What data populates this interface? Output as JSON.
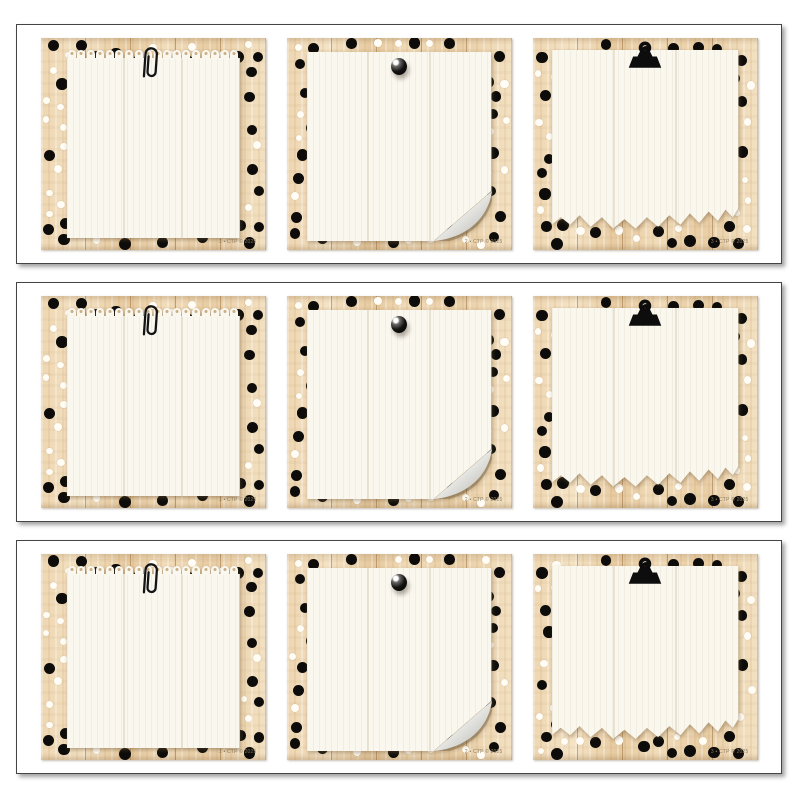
{
  "sheet": {
    "strip_count": 3,
    "cards_per_strip": 3
  },
  "strips": [
    {
      "cards": [
        {
          "number": "1",
          "attachment": "paper-clip",
          "paper_style": "perforated-notepad",
          "code": "1 • CTP © 2025"
        },
        {
          "number": "2",
          "attachment": "push-pin",
          "paper_style": "curled-corner",
          "code": "2 • CTP © 2025"
        },
        {
          "number": "3",
          "attachment": "binder-clip",
          "paper_style": "torn-bottom",
          "code": "3 • CTP © 2025"
        }
      ]
    },
    {
      "cards": [
        {
          "number": "1",
          "attachment": "paper-clip",
          "paper_style": "perforated-notepad",
          "code": "1 • CTP © 2025"
        },
        {
          "number": "2",
          "attachment": "push-pin",
          "paper_style": "curled-corner",
          "code": "2 • CTP © 2025"
        },
        {
          "number": "3",
          "attachment": "binder-clip",
          "paper_style": "torn-bottom",
          "code": "3 • CTP © 2025"
        }
      ]
    },
    {
      "cards": [
        {
          "number": "1",
          "attachment": "paper-clip",
          "paper_style": "perforated-notepad",
          "code": "1 • CTP © 2025"
        },
        {
          "number": "2",
          "attachment": "push-pin",
          "paper_style": "curled-corner",
          "code": "2 • CTP © 2025"
        },
        {
          "number": "3",
          "attachment": "binder-clip",
          "paper_style": "torn-bottom",
          "code": "3 • CTP © 2025"
        }
      ]
    }
  ],
  "colors": {
    "wood_base": "#ead0a9",
    "wood_light": "#f4e3c5",
    "wood_dark": "#e2c294",
    "plank_line": "#a97f4f",
    "dot_black": "#0d0c0a",
    "dot_white": "#fffdf6",
    "paper": "#faf7ef",
    "strip_border": "#454545",
    "code_text": "#8a7a5e",
    "curl_underside": "#c6c5c1"
  }
}
